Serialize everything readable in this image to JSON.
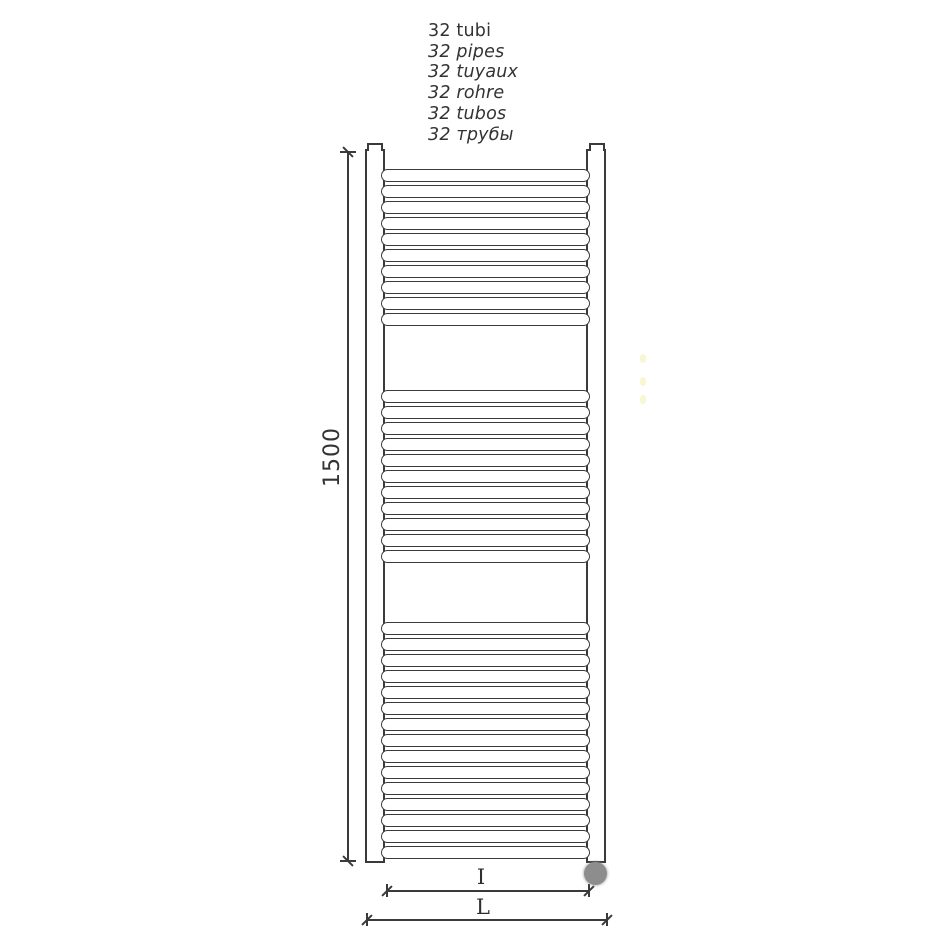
{
  "labels": {
    "tube_lines": [
      {
        "text": "32 tubi",
        "italic": false
      },
      {
        "text": "32 pipes",
        "italic": true
      },
      {
        "text": "32 tuyaux",
        "italic": true
      },
      {
        "text": "32 rohre",
        "italic": true
      },
      {
        "text": "32 tubos",
        "italic": true
      },
      {
        "text": "32 трубы",
        "italic": true
      }
    ]
  },
  "dimensions": {
    "height": "1500",
    "tube_span": "I",
    "overall_width": "L"
  },
  "radiator": {
    "tube_count": 32,
    "tube_groups": [
      10,
      11,
      15
    ]
  },
  "colors": {
    "line": "#3a3a3a",
    "text": "#333333",
    "knob_fill": "#8d8d8d",
    "artifact": "#f6f6cc"
  }
}
